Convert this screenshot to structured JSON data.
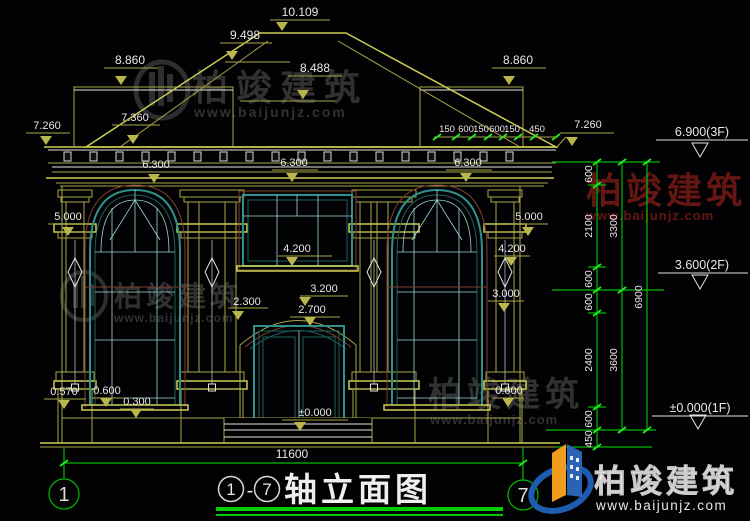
{
  "drawing_title": {
    "left_axis": "1",
    "dash": "-",
    "right_axis": "7",
    "name": "轴立面图"
  },
  "axes": {
    "left_bubble": "1",
    "right_bubble": "7"
  },
  "bottom": {
    "overall_width": "11600"
  },
  "elevation_marks": {
    "ridge": "10.109",
    "hip_upper": "9.498",
    "hip_mid": "8.488",
    "wing_left": "8.860",
    "wing_right": "8.860",
    "eave_left": "7.260",
    "eave_left_inner": "7.360",
    "eave_right": "7.260",
    "cornice_left": "6.300",
    "cornice_center": "6.300",
    "cornice_right": "6.300",
    "capital_left": "5.000",
    "capital_right": "5.000",
    "sill_2f_center": "4.200",
    "sill_2f_right": "4.200",
    "arch_peak": "3.200",
    "arch_spring": "2.300",
    "door_head": "2.700",
    "window_head_right": "3.000",
    "plinth_left": "0.570",
    "sill_1f_left": "0.600",
    "base_left": "0.300",
    "sill_1f_right": "0.600",
    "floor_level": "±0.000"
  },
  "right_panel": {
    "levels": {
      "f3": "6.900(3F)",
      "f2": "3.600(2F)",
      "f1": "±0.000(1F)"
    },
    "eave_detail_dims": [
      "150",
      "600",
      "150",
      "600",
      "150",
      "450"
    ],
    "chain_inner": [
      "600",
      "2100",
      "600",
      "600",
      "2400",
      "600",
      "450"
    ],
    "chain_mid": [
      "3300",
      "3600"
    ],
    "chain_outer": [
      "6900"
    ]
  },
  "watermark": {
    "brand": "柏竣建筑",
    "url": "www.baijunjz.com"
  },
  "colors": {
    "background": "#020204",
    "cad_olive": "#a8a546",
    "cad_bright": "#cdcd55",
    "cad_white": "#e4e4e4",
    "window_teal": "#2f8f8a",
    "trim_redbrown": "#7a4030",
    "dimension_green": "#00bd00",
    "watermark_red": "#a0241c",
    "logo_orange": "#f09d1e",
    "logo_blue": "#2a62b4",
    "title_underline_green": "#00cc00"
  }
}
